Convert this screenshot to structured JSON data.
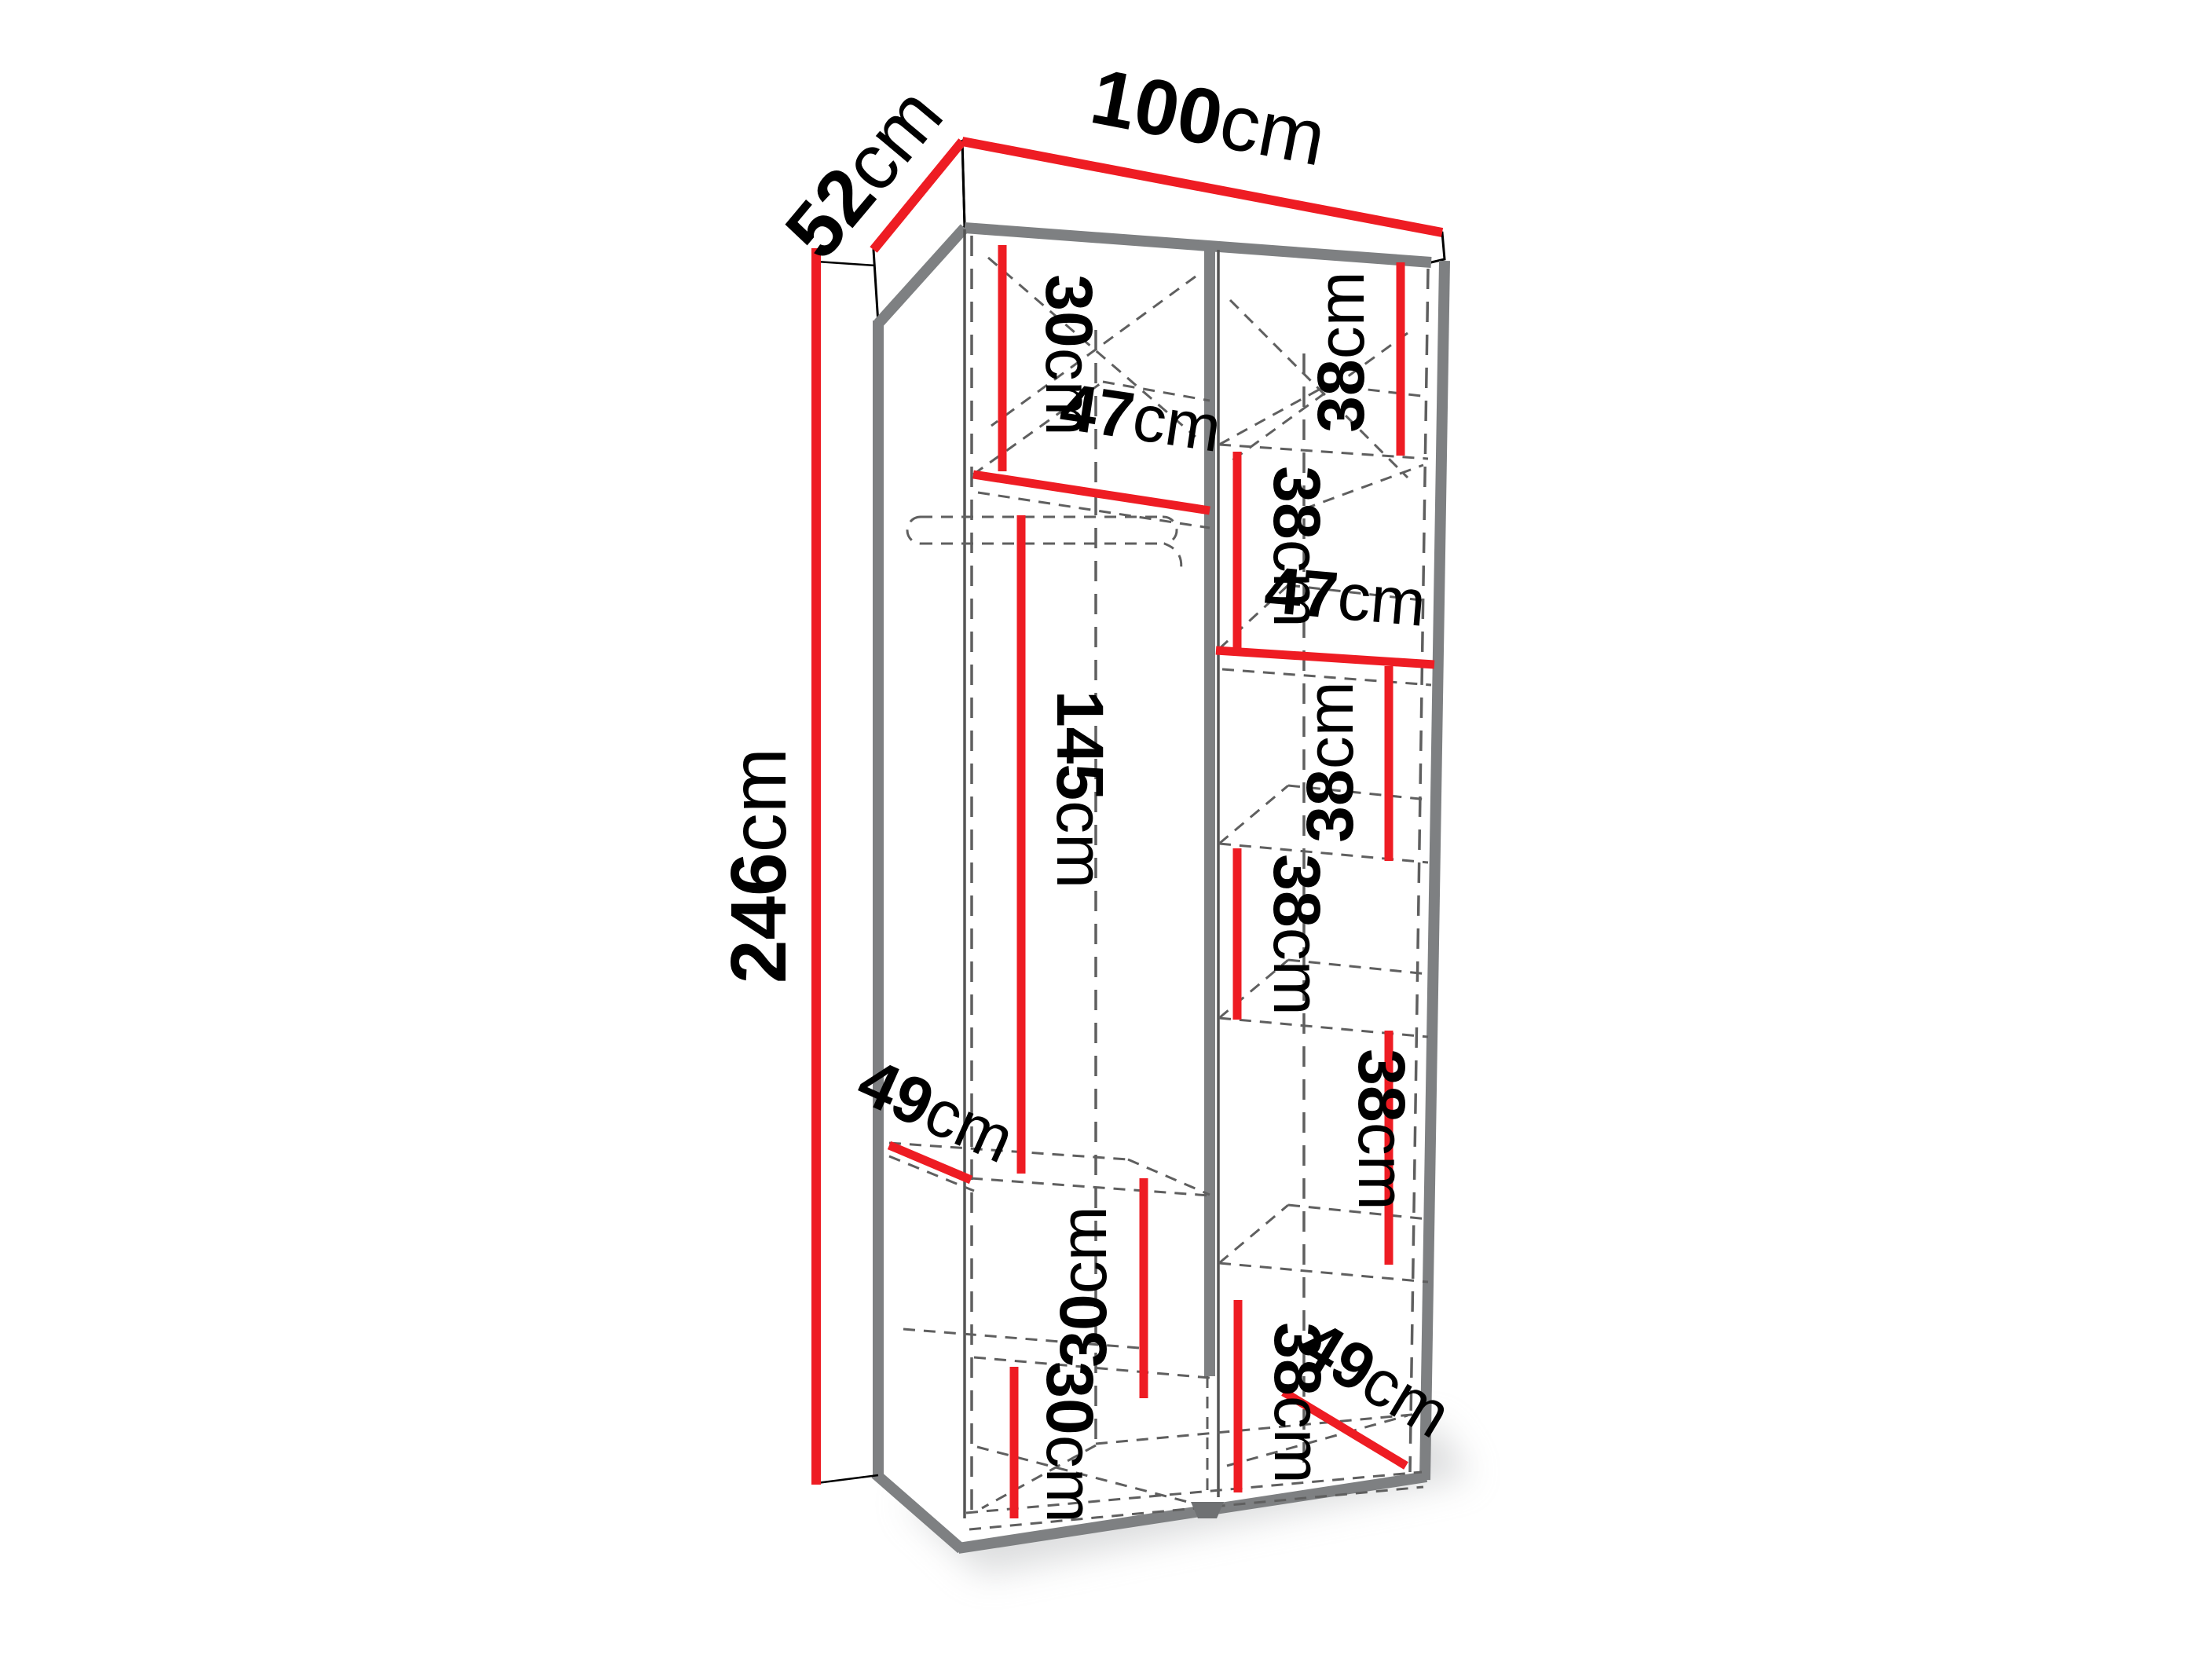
{
  "diagram": {
    "kind": "furniture-dimension-diagram",
    "subject": "two-column wardrobe interior, open front, oblique projection",
    "colors": {
      "dimension_red": "#ee1c23",
      "edge_gray": "#7e8082",
      "dash_gray": "#5f5f5f",
      "text": "#000000",
      "background": "#ffffff"
    }
  },
  "overall": {
    "width": {
      "value": "100",
      "unit": "cm"
    },
    "depth": {
      "value": "52",
      "unit": "cm"
    },
    "height": {
      "value": "246",
      "unit": "cm"
    }
  },
  "dims": [
    {
      "id": "overall-width",
      "value": "100",
      "unit": "cm"
    },
    {
      "id": "overall-depth",
      "value": "52",
      "unit": "cm"
    },
    {
      "id": "overall-height",
      "value": "246",
      "unit": "cm"
    },
    {
      "id": "left-top-section",
      "value": "30",
      "unit": "cm"
    },
    {
      "id": "left-shelf-width",
      "value": "47",
      "unit": "cm"
    },
    {
      "id": "left-hanging-height",
      "value": "145",
      "unit": "cm"
    },
    {
      "id": "left-shelf-depth",
      "value": "49",
      "unit": "cm"
    },
    {
      "id": "left-mid-section",
      "value": "30",
      "unit": "cm"
    },
    {
      "id": "left-bottom-section",
      "value": "30",
      "unit": "cm"
    },
    {
      "id": "right-section-1",
      "value": "38",
      "unit": "cm"
    },
    {
      "id": "right-section-2",
      "value": "38",
      "unit": "cm"
    },
    {
      "id": "right-shelf-width",
      "value": "47",
      "unit": "cm"
    },
    {
      "id": "right-section-3",
      "value": "38",
      "unit": "cm"
    },
    {
      "id": "right-section-4",
      "value": "38",
      "unit": "cm"
    },
    {
      "id": "right-section-5",
      "value": "38",
      "unit": "cm"
    },
    {
      "id": "right-section-6",
      "value": "38",
      "unit": "cm"
    },
    {
      "id": "right-shelf-depth",
      "value": "49",
      "unit": "cm"
    }
  ]
}
